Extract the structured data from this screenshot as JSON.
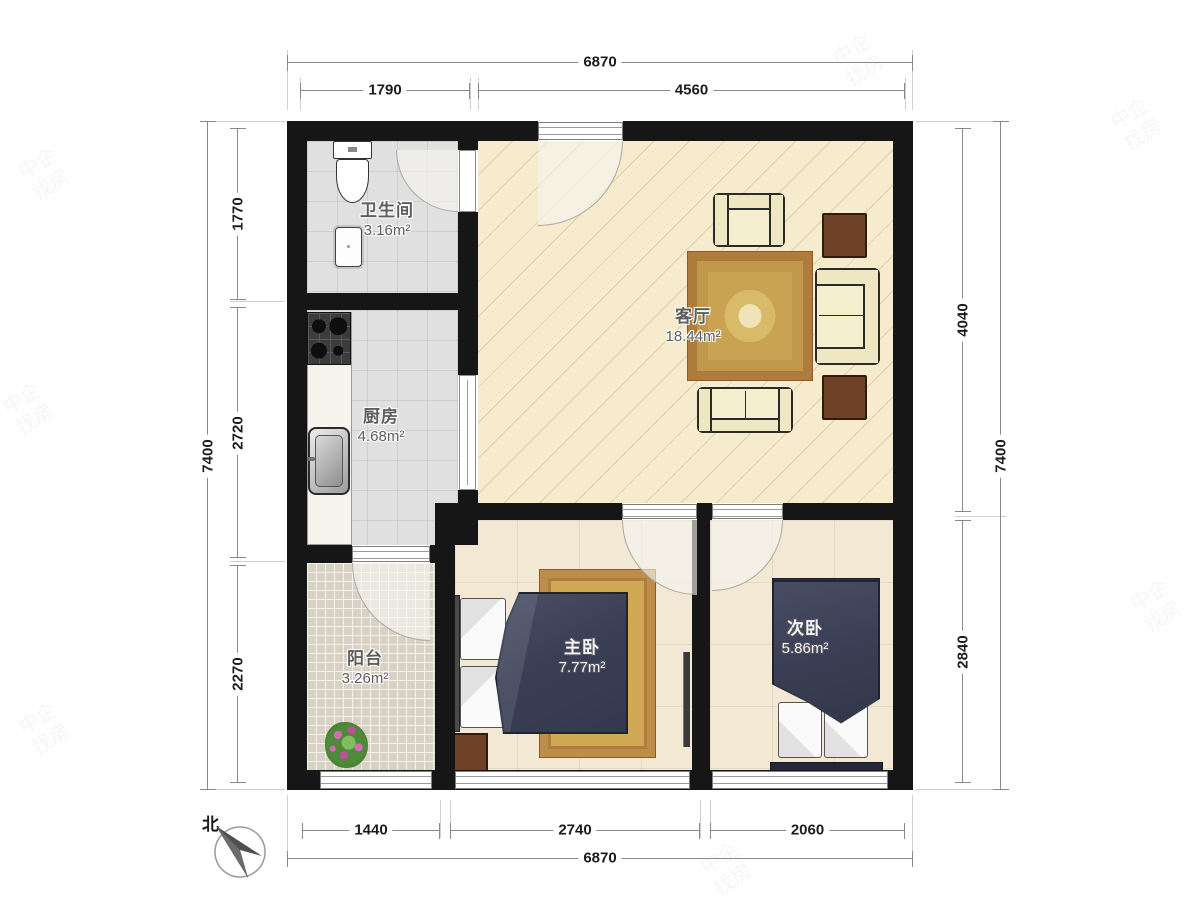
{
  "plan": {
    "rooms": {
      "bathroom": {
        "name": "卫生间",
        "area": "3.16m²"
      },
      "kitchen": {
        "name": "厨房",
        "area": "4.68m²"
      },
      "living": {
        "name": "客厅",
        "area": "18.44m²"
      },
      "master": {
        "name": "主卧",
        "area": "7.77m²"
      },
      "second": {
        "name": "次卧",
        "area": "5.86m²"
      },
      "balcony": {
        "name": "阳台",
        "area": "3.26m²"
      }
    },
    "dimensions": {
      "top": {
        "overall": "6870",
        "seg1": "1790",
        "seg2": "4560"
      },
      "bottom": {
        "overall": "6870",
        "seg1": "1440",
        "seg2": "2740",
        "seg3": "2060"
      },
      "left": {
        "overall": "7400",
        "seg1": "1770",
        "seg2": "2720",
        "seg3": "2270"
      },
      "right": {
        "overall": "7400",
        "seg1": "4040",
        "seg2": "2840"
      }
    },
    "compass": {
      "label": "北"
    },
    "watermark": {
      "text": "中企找房"
    },
    "colors": {
      "wall": "#161616",
      "living_floor": "#f7ebce",
      "tile_floor": "#e0e0e0",
      "bedroom_floor": "#f2e8d3",
      "balcony_floor": "#d8d2c4",
      "carpet_gold": "#c9a352",
      "bed_navy": "#3a3f55",
      "sofa_cream": "#f5eecf",
      "wood_brown": "#6e4227"
    }
  }
}
